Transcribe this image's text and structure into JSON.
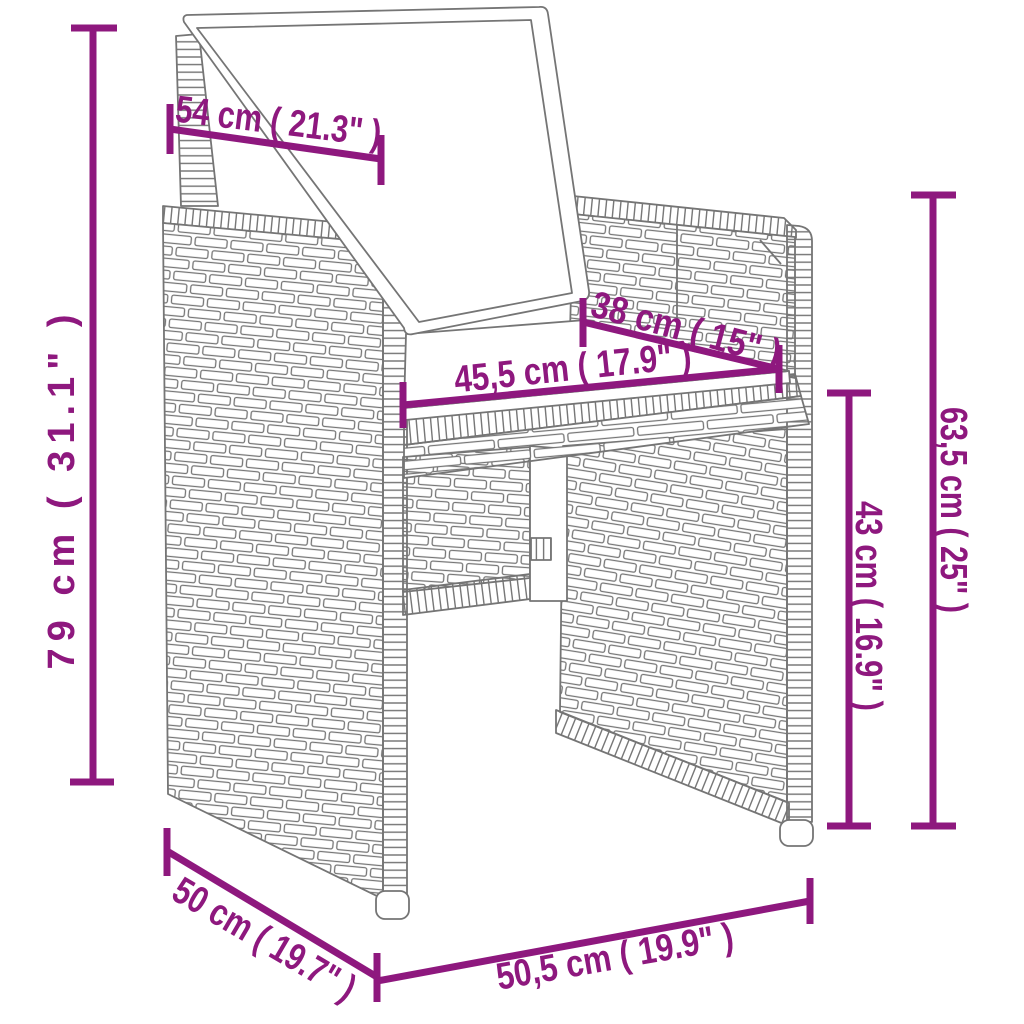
{
  "diagram": {
    "kind": "product-dimension-diagram",
    "product": "poly-rattan garden armchair with cushions",
    "accent_color": "#8E187E",
    "line_art_color": "#757575",
    "background_color": "#ffffff",
    "dimensions": [
      {
        "name": "backrest-cushion-width",
        "label": "54 cm ( 21.3\" )"
      },
      {
        "name": "total-height",
        "label": "79 cm ( 31.1\" )"
      },
      {
        "name": "seat-depth",
        "label": "38 cm ( 15\" )"
      },
      {
        "name": "seat-width",
        "label": "45,5 cm ( 17.9\" )"
      },
      {
        "name": "armrest-panel-height",
        "label": "63,5 cm ( 25\" )"
      },
      {
        "name": "seat-height",
        "label": "43 cm ( 16.9\" )"
      },
      {
        "name": "base-depth",
        "label": "50 cm ( 19.7\" )"
      },
      {
        "name": "base-width",
        "label": "50,5 cm ( 19.9\" )"
      }
    ]
  }
}
